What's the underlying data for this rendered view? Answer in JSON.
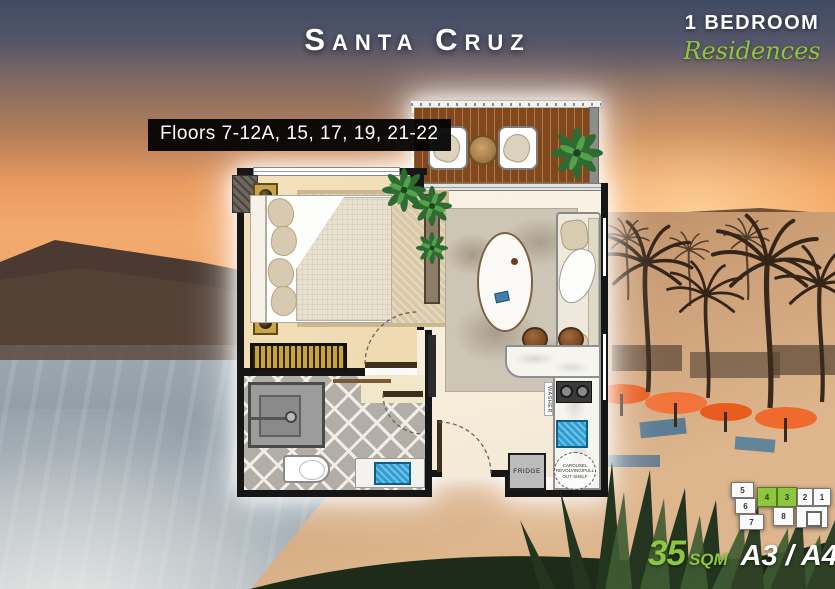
{
  "colors": {
    "accent_green": "#8dc63f",
    "label_bg": "#000000",
    "title_color": "#ffffff"
  },
  "header": {
    "title": "Santa Cruz",
    "badge_line1": "1 BEDROOM",
    "badge_line2": "Residences"
  },
  "floors_label": {
    "text": "Floors 7-12A, 15, 17, 19, 21-22"
  },
  "plan": {
    "labels": {
      "washer": "WASHER",
      "fridge": "FRIDGE",
      "carousel_note": "CAROUSEL REVOLVING/PULL OUT SHELF"
    }
  },
  "key_plan": {
    "units": [
      {
        "num": "5",
        "highlighted": false
      },
      {
        "num": "6",
        "highlighted": false
      },
      {
        "num": "7",
        "highlighted": false
      },
      {
        "num": "4",
        "highlighted": true
      },
      {
        "num": "3",
        "highlighted": true
      },
      {
        "num": "2",
        "highlighted": false
      },
      {
        "num": "1",
        "highlighted": false
      },
      {
        "num": "8",
        "highlighted": false
      }
    ]
  },
  "footer": {
    "area_value": "35",
    "area_unit": "SQM",
    "unit_codes": "A3 / A4"
  }
}
